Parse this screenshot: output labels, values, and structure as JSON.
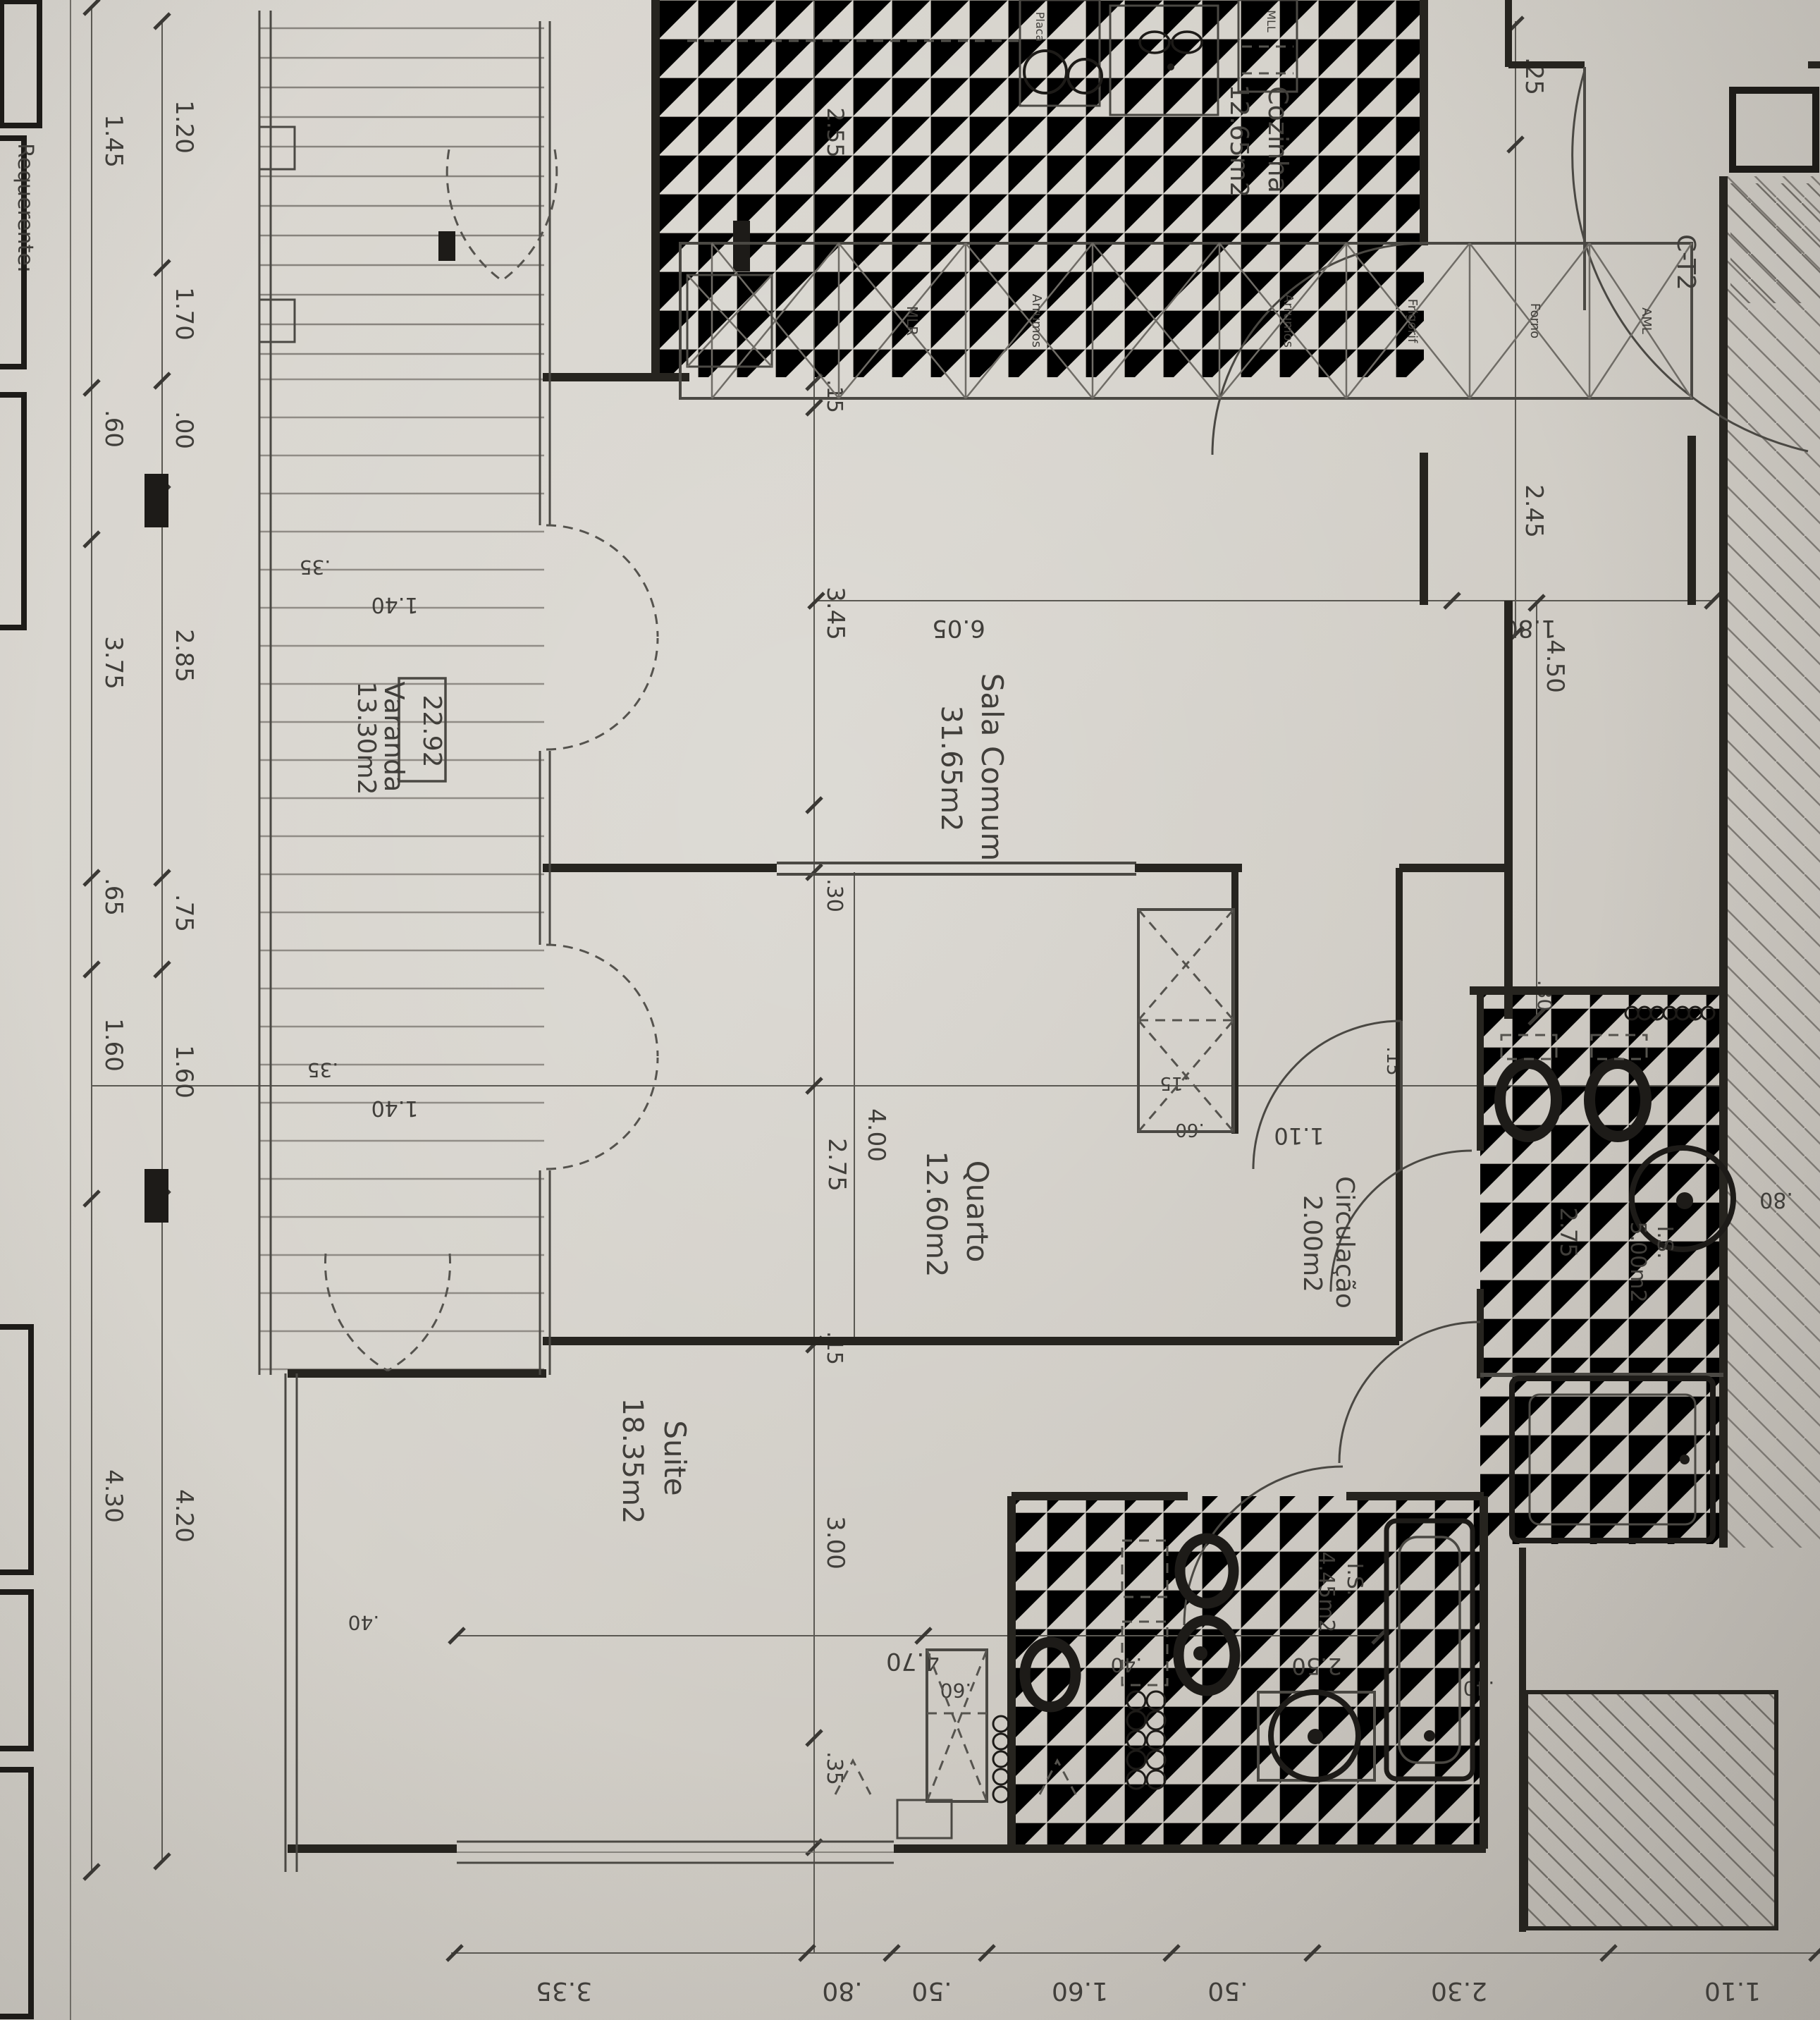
{
  "sheet": {
    "requerente": "Requerente:",
    "unit_code": "C-T2",
    "level_mark": "22.92"
  },
  "rooms": {
    "sala": {
      "name": "Sala Comum",
      "area": "31.65m2"
    },
    "quarto": {
      "name": "Quarto",
      "area": "12.60m2"
    },
    "suite": {
      "name": "Suite",
      "area": "18.35m2"
    },
    "cozinha": {
      "name": "Cozinha",
      "area": "12.65m2"
    },
    "varanda": {
      "name": "Varanda",
      "area": "13.30m2"
    },
    "circulacao": {
      "name": "Circulação",
      "area": "2.00m2"
    },
    "is1": {
      "name": "I.S.",
      "area": "5.00m2"
    },
    "is2": {
      "name": "I.S.",
      "area": "4.45m2"
    }
  },
  "kitchen": {
    "placa": "Placa",
    "mll": "MLL",
    "units": [
      "",
      "MLR",
      "Arrumos",
      "",
      "Arrumos",
      "Frigorif",
      "Forno",
      "AML"
    ]
  },
  "dims": {
    "left_outer": [
      "1.45",
      ".60",
      "3.75",
      ".65",
      "1.60",
      "4.30"
    ],
    "left_inner": [
      "1.20",
      "1.70",
      ".00",
      "2.85",
      ".75",
      "1.60",
      "4.20"
    ],
    "bottom": [
      "3.35",
      ".80",
      ".50",
      "1.60",
      ".50",
      "2.30",
      "1.10"
    ],
    "top_right": [
      ".25",
      "2.45"
    ],
    "kitchen_left": [
      "2.55"
    ],
    "sala": [
      ".15",
      "3.45",
      "6.05",
      "1.80",
      "4.50",
      ".30"
    ],
    "quarto": [
      "2.75",
      "4.00",
      "1.10",
      ".15",
      ".60",
      ".15"
    ],
    "suite": [
      ".15",
      "3.00",
      ".35",
      "4.70"
    ],
    "varanda": [
      ".35",
      "1.40",
      ".35",
      "1.40",
      ".40"
    ],
    "bath1": [
      "2.75",
      ".30",
      ".80"
    ],
    "bath2": [
      "2.50",
      ".40",
      ".60",
      ".40"
    ]
  }
}
